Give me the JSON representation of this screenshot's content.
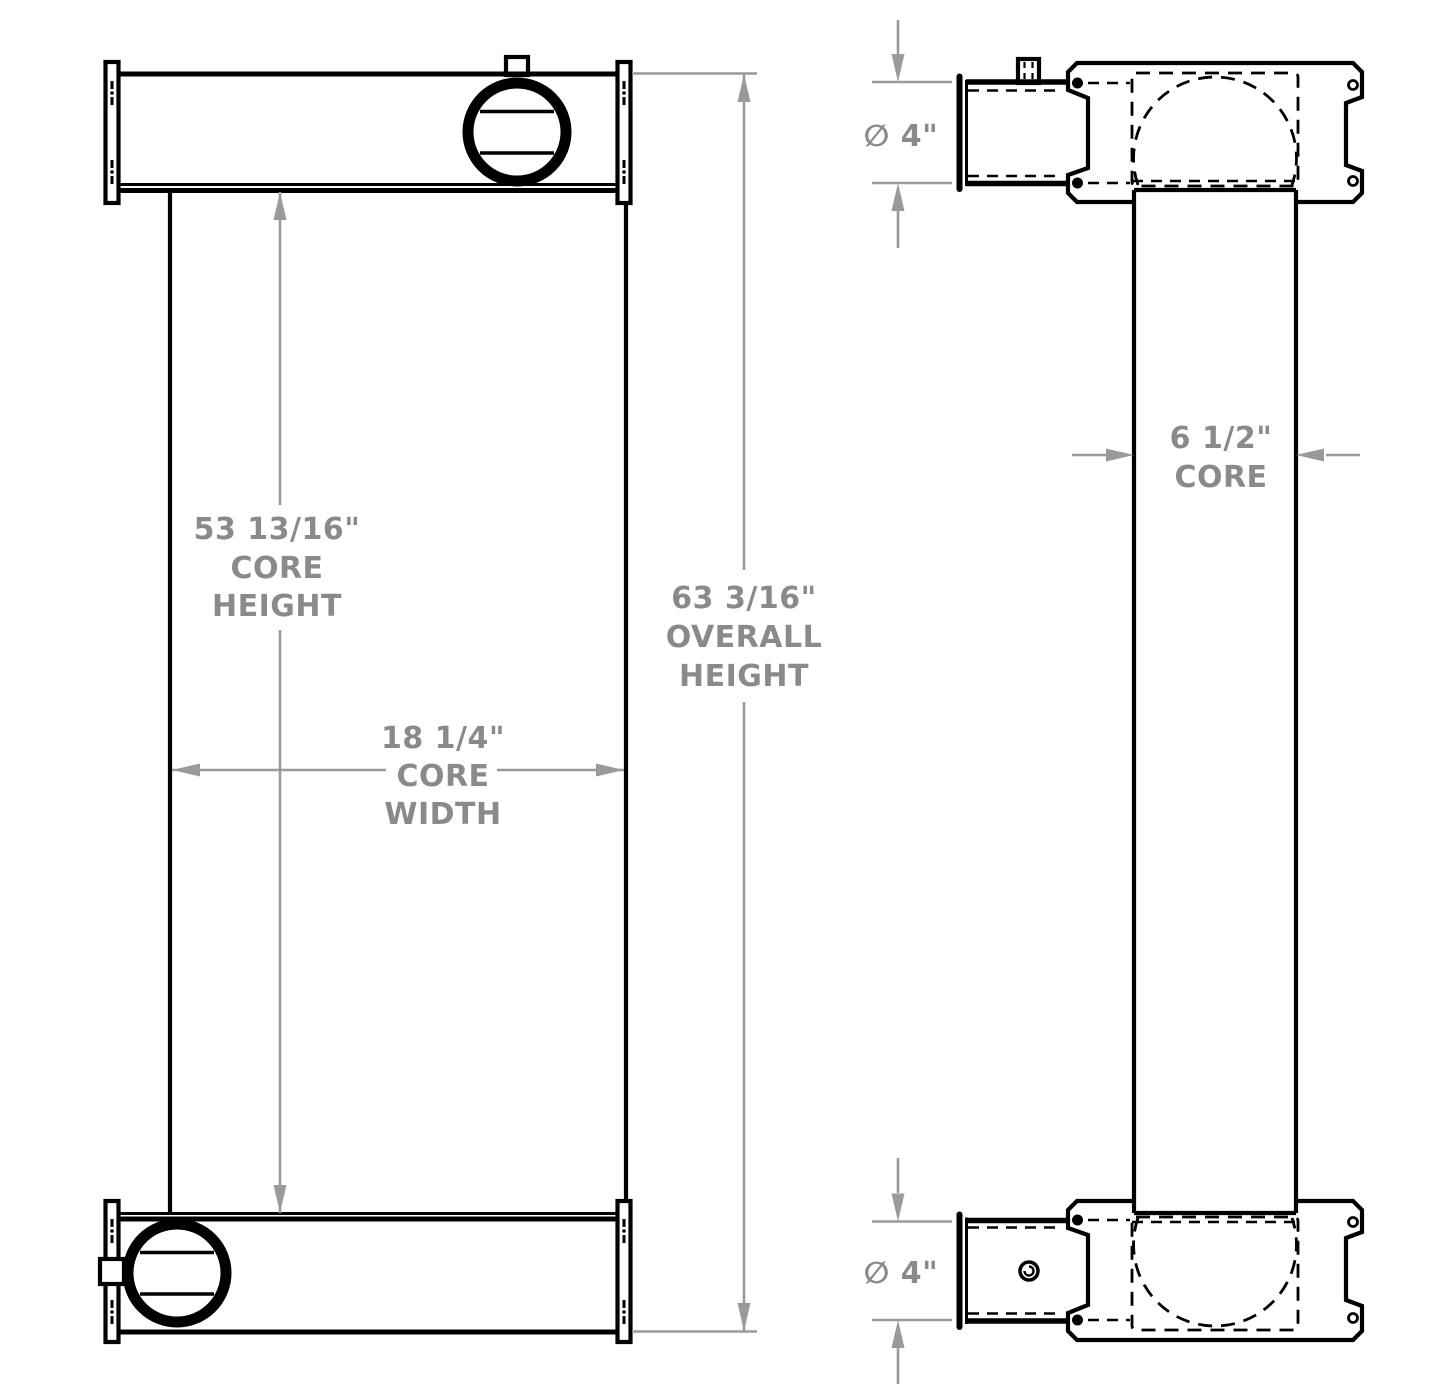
{
  "drawing": {
    "type": "technical-dimension-drawing",
    "views": [
      "front",
      "side"
    ],
    "colors": {
      "line": "#000000",
      "dimension_line": "#9a9a9a",
      "dimension_text": "#8a8a8a",
      "background": "#ffffff"
    },
    "front_view": {
      "core_height_lines": [
        "53 13/16\"",
        "CORE",
        "HEIGHT"
      ],
      "overall_height_lines": [
        "63 3/16\"",
        "OVERALL",
        "HEIGHT"
      ],
      "core_width_lines": [
        "18 1/4\"",
        "CORE",
        "WIDTH"
      ]
    },
    "side_view": {
      "core_depth_lines": [
        "6 1/2\"",
        "CORE"
      ],
      "top_port_diameter": "∅ 4\"",
      "bottom_port_diameter": "∅ 4\""
    }
  }
}
